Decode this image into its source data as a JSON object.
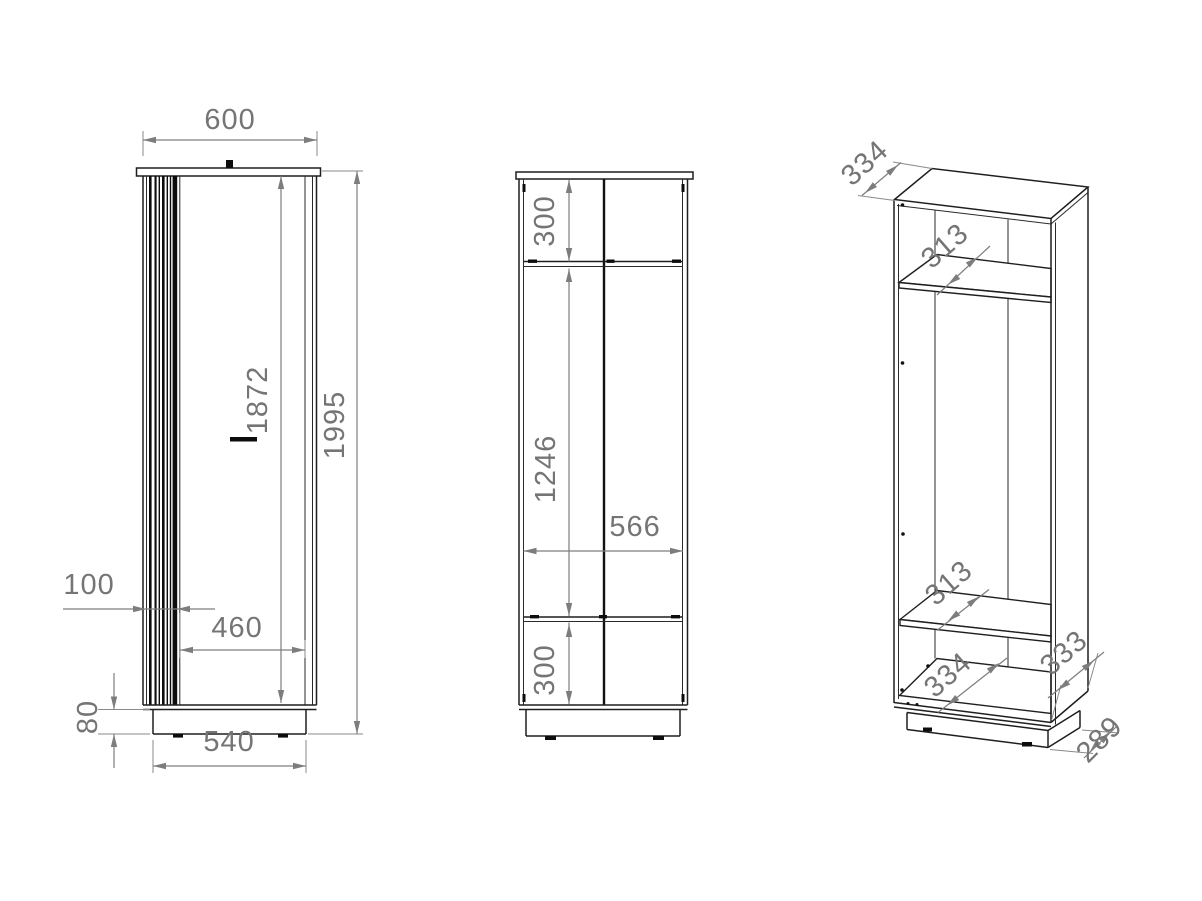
{
  "drawing": {
    "colors": {
      "line": "#1f1f1f",
      "dimension_gray": "#7d7d7d",
      "background": "#ffffff"
    },
    "views": {
      "front": {
        "dims": {
          "width": "600",
          "door_height": "1872",
          "total_height": "1995",
          "slat_panel_width": "100",
          "door_width": "460",
          "plinth_height": "80",
          "plinth_width": "540"
        }
      },
      "internal": {
        "dims": {
          "top_compartment": "300",
          "middle_compartment": "1246",
          "interior_width": "566",
          "bottom_compartment": "300"
        }
      },
      "perspective": {
        "dims": {
          "top_depth": "334",
          "upper_shelf_depth": "313",
          "lower_shelf_depth": "313",
          "bottom_depth": "334",
          "side_bottom_depth": "333",
          "plinth_depth": "289"
        }
      }
    }
  }
}
